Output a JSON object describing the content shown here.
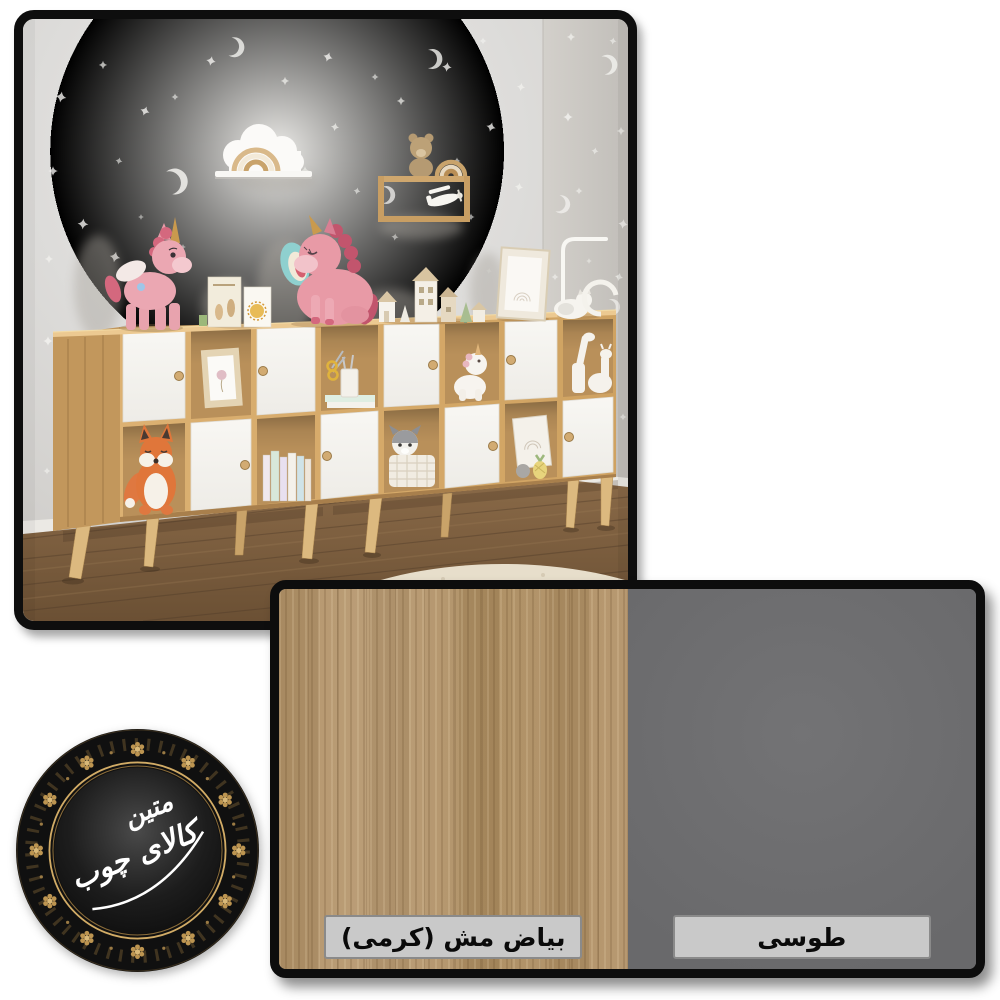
{
  "canvas": {
    "width": 1000,
    "height": 1000,
    "background": "#ffffff"
  },
  "photo": {
    "type": "kids-room-furniture-render",
    "wall_color": "#dcdbd8",
    "floor_color": "#7b5d3f",
    "shelf_wood_color": "#d6aa6a",
    "door_color": "#f5f4f1",
    "objects": [
      "cube storage shelf",
      "pink unicorn plush",
      "fox plush",
      "cloud wall shelf",
      "wood wall shelf with teddy",
      "floor lamp",
      "round rug",
      "stars and moons wallpaper"
    ]
  },
  "swatch_panel": {
    "swatches": [
      {
        "label": "بیاض مش (کرمی)",
        "color": "#b29269",
        "finish": "wood-grain"
      },
      {
        "label": "طوسی",
        "color": "#6f6f71",
        "finish": "plain"
      }
    ],
    "label_background": "#c9c9c9",
    "label_border": "#8a8a8a"
  },
  "logo": {
    "brand_line1": "متین",
    "brand_line2": "کالای چوب",
    "full_name": "کالای چوب متین",
    "gold": "#c19a55",
    "background": "#121212",
    "text_color": "#ffffff"
  }
}
